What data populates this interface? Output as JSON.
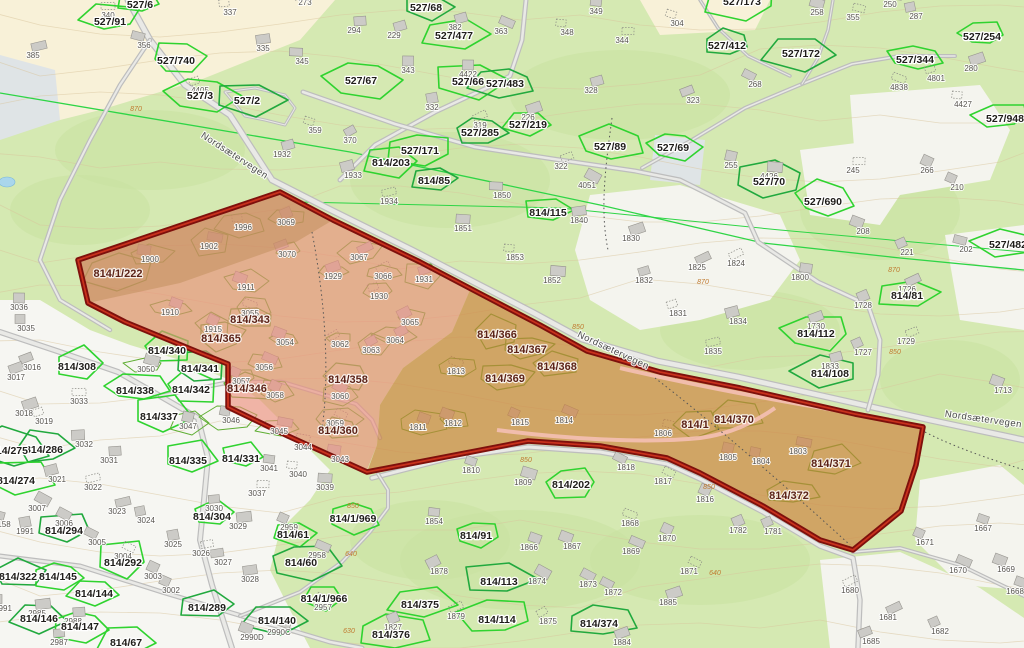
{
  "map": {
    "road_name": "Nordsætervegen",
    "colors": {
      "background_green": "#d5e9b2",
      "vegetation_dark": "#c8e2a0",
      "open_land": "#f4f4ee",
      "cream": "#f8f1d8",
      "residential_white": "#f6f6f2",
      "marsh_gray": "#dfe4e6",
      "pond_blue": "#a9d6ec",
      "contour": "#d8c49c",
      "road_gray": "#bdbdbd",
      "road_fill": "#e9e9e6",
      "parcel_green_bright": "#2fd32f",
      "parcel_green_dark": "#21a93e",
      "zone_parcel_green": "#5fae33",
      "boundary_line_green": "#2ed546",
      "zone_pink": "#ec8a78",
      "zone_orange": "#cd7f3a",
      "zone_tan": "#bb8a55",
      "zone_border_dark": "#7e100c",
      "zone_border_bright": "#c8311d",
      "zone_inner_road_pink": "#f4c0b4"
    },
    "labels": {
      "parcels": [
        [
          "527/6",
          140,
          8
        ],
        [
          "527/91",
          110,
          25
        ],
        [
          "527/740",
          176,
          64
        ],
        [
          "527/3",
          200,
          99
        ],
        [
          "527/2",
          247,
          104
        ],
        [
          "527/68",
          426,
          11
        ],
        [
          "527/477",
          454,
          39
        ],
        [
          "527/67",
          361,
          84
        ],
        [
          "527/66",
          468,
          85
        ],
        [
          "527/483",
          505,
          87
        ],
        [
          "527/219",
          528,
          128
        ],
        [
          "527/285",
          480,
          136
        ],
        [
          "527/89",
          610,
          150
        ],
        [
          "527/171",
          420,
          154
        ],
        [
          "814/203",
          391,
          166
        ],
        [
          "814/85",
          434,
          184
        ],
        [
          "814/115",
          548,
          216
        ],
        [
          "527/173",
          742,
          5
        ],
        [
          "527/412",
          727,
          49
        ],
        [
          "527/172",
          801,
          57
        ],
        [
          "527/344",
          915,
          63
        ],
        [
          "527/254",
          982,
          40
        ],
        [
          "527/948",
          1005,
          122
        ],
        [
          "527/69",
          673,
          151
        ],
        [
          "527/70",
          769,
          185
        ],
        [
          "527/690",
          823,
          205
        ],
        [
          "527/482",
          1008,
          248
        ],
        [
          "814/81",
          907,
          299
        ],
        [
          "814/112",
          816,
          337
        ],
        [
          "814/108",
          830,
          377
        ],
        [
          "814/308",
          77,
          370
        ],
        [
          "814/340",
          167,
          354
        ],
        [
          "814/341",
          200,
          372
        ],
        [
          "814/342",
          191,
          393
        ],
        [
          "814/338",
          135,
          394
        ],
        [
          "814/337",
          159,
          420
        ],
        [
          "814/335",
          188,
          464
        ],
        [
          "814/331",
          241,
          462
        ],
        [
          "814/304",
          212,
          520
        ],
        [
          "814/286",
          44,
          453
        ],
        [
          "814/275",
          9,
          454
        ],
        [
          "814/274",
          16,
          484
        ],
        [
          "814/294",
          64,
          534
        ],
        [
          "814/322",
          18,
          580
        ],
        [
          "814/145",
          58,
          580
        ],
        [
          "814/144",
          94,
          597
        ],
        [
          "814/146",
          39,
          622
        ],
        [
          "814/147",
          80,
          630
        ],
        [
          "814/292",
          123,
          566
        ],
        [
          "814/289",
          207,
          611
        ],
        [
          "814/140",
          277,
          624
        ],
        [
          "814/61",
          293,
          538
        ],
        [
          "814/60",
          301,
          566
        ],
        [
          "814/1/969",
          353,
          522
        ],
        [
          "814/1/966",
          324,
          602
        ],
        [
          "814/202",
          571,
          488
        ],
        [
          "814/91",
          476,
          539
        ],
        [
          "814/113",
          499,
          585
        ],
        [
          "814/114",
          497,
          623
        ],
        [
          "814/375",
          420,
          608
        ],
        [
          "814/376",
          391,
          638
        ],
        [
          "814/374",
          599,
          627
        ],
        [
          "814/67",
          126,
          646
        ]
      ],
      "zone_parcels": [
        [
          "814/1/222",
          118,
          277
        ],
        [
          "814/343",
          250,
          323
        ],
        [
          "814/365",
          221,
          342
        ],
        [
          "814/358",
          348,
          383
        ],
        [
          "814/346",
          247,
          392
        ],
        [
          "814/360",
          338,
          434
        ],
        [
          "814/366",
          497,
          338
        ],
        [
          "814/367",
          527,
          353
        ],
        [
          "814/368",
          557,
          370
        ],
        [
          "814/369",
          505,
          382
        ],
        [
          "814/370",
          734,
          423
        ],
        [
          "814/371",
          831,
          467
        ],
        [
          "814/372",
          789,
          499
        ],
        [
          "814/1",
          695,
          428
        ]
      ],
      "buildings": [
        [
          "340",
          108,
          18
        ],
        [
          "356",
          144,
          48
        ],
        [
          "385",
          33,
          58
        ],
        [
          "337",
          230,
          15
        ],
        [
          "273",
          305,
          5
        ],
        [
          "335",
          263,
          51
        ],
        [
          "345",
          302,
          64
        ],
        [
          "359",
          315,
          133
        ],
        [
          "1932",
          282,
          157
        ],
        [
          "370",
          350,
          143
        ],
        [
          "294",
          354,
          33
        ],
        [
          "229",
          394,
          38
        ],
        [
          "382",
          455,
          30
        ],
        [
          "343",
          408,
          73
        ],
        [
          "4422",
          468,
          77
        ],
        [
          "363",
          501,
          34
        ],
        [
          "348",
          567,
          35
        ],
        [
          "349",
          596,
          14
        ],
        [
          "344",
          622,
          43
        ],
        [
          "328",
          591,
          93
        ],
        [
          "332",
          432,
          110
        ],
        [
          "319",
          480,
          128
        ],
        [
          "226",
          528,
          120
        ],
        [
          "322",
          561,
          169
        ],
        [
          "4051",
          587,
          188
        ],
        [
          "1850",
          502,
          198
        ],
        [
          "1933",
          353,
          178
        ],
        [
          "1934",
          389,
          204
        ],
        [
          "304",
          677,
          26
        ],
        [
          "258",
          817,
          15
        ],
        [
          "355",
          853,
          20
        ],
        [
          "287",
          916,
          19
        ],
        [
          "250",
          890,
          7
        ],
        [
          "268",
          755,
          87
        ],
        [
          "323",
          693,
          103
        ],
        [
          "280",
          971,
          71
        ],
        [
          "4838",
          899,
          90
        ],
        [
          "4801",
          936,
          81
        ],
        [
          "4427",
          963,
          107
        ],
        [
          "255",
          731,
          168
        ],
        [
          "4426",
          769,
          179
        ],
        [
          "245",
          853,
          173
        ],
        [
          "266",
          927,
          173
        ],
        [
          "210",
          957,
          190
        ],
        [
          "208",
          863,
          234
        ],
        [
          "221",
          907,
          255
        ],
        [
          "202",
          966,
          252
        ],
        [
          "1726",
          907,
          292
        ],
        [
          "1728",
          863,
          308
        ],
        [
          "1729",
          906,
          344
        ],
        [
          "1727",
          863,
          355
        ],
        [
          "1713",
          1003,
          393
        ],
        [
          "1800",
          800,
          280
        ],
        [
          "1825",
          697,
          270
        ],
        [
          "1824",
          736,
          266
        ],
        [
          "1831",
          678,
          316
        ],
        [
          "1834",
          738,
          324
        ],
        [
          "1835",
          713,
          354
        ],
        [
          "1830",
          631,
          241
        ],
        [
          "1833",
          830,
          369
        ],
        [
          "1730",
          816,
          329
        ],
        [
          "1840",
          579,
          223
        ],
        [
          "1851",
          463,
          231
        ],
        [
          "1852",
          552,
          283
        ],
        [
          "1853",
          515,
          260
        ],
        [
          "1832",
          644,
          283
        ],
        [
          "4405",
          200,
          93
        ],
        [
          "1900",
          150,
          262
        ],
        [
          "1902",
          209,
          249
        ],
        [
          "1996",
          243,
          230
        ],
        [
          "3069",
          286,
          225
        ],
        [
          "3070",
          287,
          257
        ],
        [
          "1929",
          333,
          279
        ],
        [
          "3067",
          359,
          260
        ],
        [
          "3066",
          383,
          279
        ],
        [
          "1930",
          379,
          299
        ],
        [
          "1931",
          424,
          282
        ],
        [
          "1911",
          246,
          290
        ],
        [
          "1910",
          170,
          315
        ],
        [
          "1915",
          213,
          332
        ],
        [
          "3055",
          250,
          316
        ],
        [
          "3054",
          285,
          345
        ],
        [
          "3062",
          340,
          347
        ],
        [
          "3063",
          371,
          353
        ],
        [
          "3064",
          395,
          343
        ],
        [
          "3065",
          410,
          325
        ],
        [
          "3056",
          264,
          370
        ],
        [
          "3057",
          241,
          384
        ],
        [
          "3058",
          275,
          398
        ],
        [
          "3060",
          340,
          399
        ],
        [
          "3059",
          335,
          426
        ],
        [
          "3050",
          146,
          372
        ],
        [
          "3033",
          79,
          404
        ],
        [
          "3047",
          188,
          429
        ],
        [
          "3046",
          231,
          423
        ],
        [
          "3045",
          279,
          434
        ],
        [
          "3044",
          303,
          450
        ],
        [
          "3043",
          340,
          462
        ],
        [
          "3041",
          269,
          471
        ],
        [
          "3040",
          298,
          477
        ],
        [
          "3039",
          325,
          490
        ],
        [
          "3037",
          257,
          496
        ],
        [
          "3036",
          19,
          310
        ],
        [
          "3035",
          26,
          331
        ],
        [
          "3016",
          32,
          370
        ],
        [
          "3017",
          16,
          380
        ],
        [
          "3018",
          24,
          416
        ],
        [
          "3019",
          44,
          424
        ],
        [
          "3032",
          84,
          447
        ],
        [
          "3031",
          109,
          463
        ],
        [
          "3021",
          57,
          482
        ],
        [
          "3022",
          93,
          490
        ],
        [
          "3023",
          117,
          514
        ],
        [
          "3024",
          146,
          523
        ],
        [
          "3025",
          173,
          547
        ],
        [
          "3026",
          201,
          556
        ],
        [
          "3027",
          223,
          565
        ],
        [
          "3028",
          250,
          582
        ],
        [
          "3029",
          238,
          529
        ],
        [
          "3030",
          214,
          511
        ],
        [
          "3007",
          37,
          511
        ],
        [
          "3006",
          64,
          526
        ],
        [
          "1991",
          25,
          534
        ],
        [
          "2985",
          37,
          616
        ],
        [
          "2988",
          73,
          624
        ],
        [
          "2987",
          59,
          645
        ],
        [
          "2991",
          3,
          611
        ],
        [
          "158",
          4,
          527
        ],
        [
          "3005",
          97,
          545
        ],
        [
          "3004",
          123,
          559
        ],
        [
          "3003",
          153,
          579
        ],
        [
          "3002",
          171,
          593
        ],
        [
          "2990D",
          252,
          640
        ],
        [
          "2990C",
          279,
          635
        ],
        [
          "2959",
          289,
          530
        ],
        [
          "2958",
          317,
          558
        ],
        [
          "2957",
          323,
          610
        ],
        [
          "1854",
          434,
          524
        ],
        [
          "1878",
          439,
          574
        ],
        [
          "1879",
          456,
          619
        ],
        [
          "1827",
          393,
          630
        ],
        [
          "1813",
          456,
          374
        ],
        [
          "1811",
          418,
          430
        ],
        [
          "1812",
          453,
          426
        ],
        [
          "1815",
          520,
          425
        ],
        [
          "1814",
          564,
          423
        ],
        [
          "1810",
          471,
          473
        ],
        [
          "1809",
          523,
          485
        ],
        [
          "1818",
          626,
          470
        ],
        [
          "1817",
          663,
          484
        ],
        [
          "1816",
          705,
          502
        ],
        [
          "1806",
          663,
          436
        ],
        [
          "1805",
          728,
          460
        ],
        [
          "1804",
          761,
          464
        ],
        [
          "1803",
          798,
          454
        ],
        [
          "1782",
          738,
          533
        ],
        [
          "1781",
          773,
          534
        ],
        [
          "1868",
          630,
          526
        ],
        [
          "1866",
          529,
          550
        ],
        [
          "1867",
          572,
          549
        ],
        [
          "1870",
          667,
          541
        ],
        [
          "1869",
          631,
          554
        ],
        [
          "1871",
          689,
          574
        ],
        [
          "1874",
          537,
          584
        ],
        [
          "1873",
          588,
          587
        ],
        [
          "1872",
          613,
          595
        ],
        [
          "1885",
          668,
          605
        ],
        [
          "1875",
          548,
          624
        ],
        [
          "1884",
          622,
          645
        ],
        [
          "1667",
          983,
          531
        ],
        [
          "1671",
          925,
          545
        ],
        [
          "1670",
          958,
          573
        ],
        [
          "1669",
          1006,
          572
        ],
        [
          "1668",
          1015,
          594
        ],
        [
          "1680",
          850,
          593
        ],
        [
          "1681",
          888,
          620
        ],
        [
          "1682",
          940,
          634
        ],
        [
          "1685",
          871,
          644
        ]
      ],
      "road_labels": [
        [
          "Nordsætervegen",
          233,
          158,
          33
        ],
        [
          "Nordsætervegen",
          612,
          353,
          25
        ],
        [
          "Nordsætervegen",
          983,
          422,
          8
        ]
      ],
      "elevation_labels": [
        [
          "870",
          136,
          111
        ],
        [
          "870",
          894,
          272
        ],
        [
          "870",
          703,
          284
        ],
        [
          "850",
          578,
          329
        ],
        [
          "850",
          526,
          462
        ],
        [
          "850",
          709,
          489
        ],
        [
          "850",
          895,
          354
        ],
        [
          "850",
          353,
          508
        ],
        [
          "640",
          351,
          556
        ],
        [
          "640",
          715,
          575
        ],
        [
          "630",
          349,
          633
        ]
      ]
    }
  }
}
